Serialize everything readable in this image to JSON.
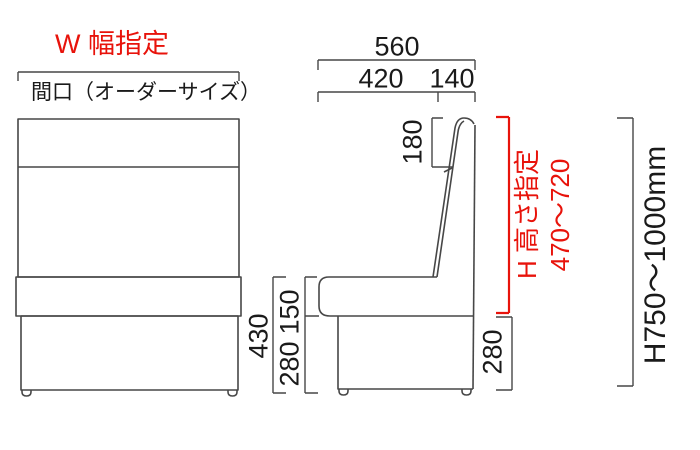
{
  "colors": {
    "line": "#474747",
    "text": "#1a1a1a",
    "red": "#e8130b"
  },
  "front_view": {
    "width_spec_label": "W 幅指定",
    "opening_label": "間口（オーダーサイズ）",
    "total_seat_height": "430",
    "seat_cushion_height": "150",
    "base_height": "280"
  },
  "side_view": {
    "total_depth": "560",
    "seat_depth": "420",
    "backrest_depth": "140",
    "backrest_top_section": "180",
    "base_height": "280",
    "height_spec_label": "H 高さ指定",
    "height_spec_range": "470〜720",
    "overall_height_range": "H750〜1000mm"
  }
}
